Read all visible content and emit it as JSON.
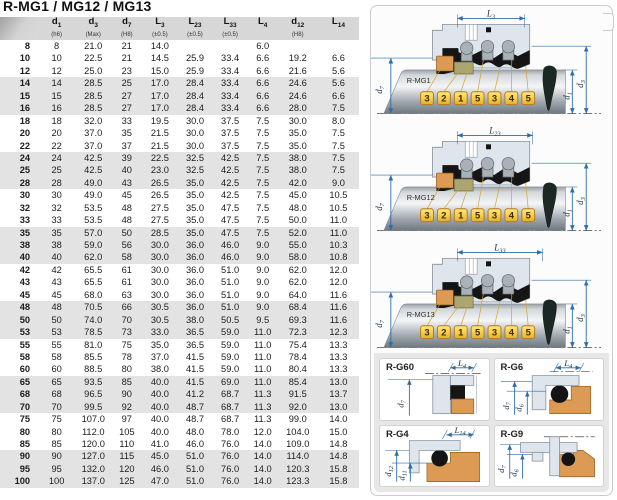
{
  "title": "R-MG1 / MG12 / MG13",
  "table": {
    "columns": [
      {
        "main": "d",
        "sub": "1",
        "note": "(h6)"
      },
      {
        "main": "d",
        "sub": "3",
        "note": "(Max)"
      },
      {
        "main": "d",
        "sub": "7",
        "note": "(H8)"
      },
      {
        "main": "L",
        "sub": "3",
        "note": "(±0.5)"
      },
      {
        "main": "L",
        "sub": "23",
        "note": "(±0.5)"
      },
      {
        "main": "L",
        "sub": "33",
        "note": "(±0.5)"
      },
      {
        "main": "L",
        "sub": "4",
        "note": ""
      },
      {
        "main": "d",
        "sub": "12",
        "note": "(H8)"
      },
      {
        "main": "L",
        "sub": "14",
        "note": ""
      }
    ],
    "rows": [
      [
        "8",
        "8",
        "21.0",
        "21",
        "14.0",
        "",
        "",
        "6.0",
        "",
        ""
      ],
      [
        "10",
        "10",
        "22.5",
        "21",
        "14.5",
        "25.9",
        "33.4",
        "6.6",
        "19.2",
        "6.6"
      ],
      [
        "12",
        "12",
        "25.0",
        "23",
        "15.0",
        "25.9",
        "33.4",
        "6.6",
        "21.6",
        "5.6"
      ],
      [
        "14",
        "14",
        "28.5",
        "25",
        "17.0",
        "28.4",
        "33.4",
        "6.6",
        "24.6",
        "5.6"
      ],
      [
        "15",
        "15",
        "28.5",
        "27",
        "17.0",
        "28.4",
        "33.4",
        "6.6",
        "24.6",
        "6.6"
      ],
      [
        "16",
        "16",
        "28.5",
        "27",
        "17.0",
        "28.4",
        "33.4",
        "6.6",
        "28.0",
        "7.5"
      ],
      [
        "18",
        "18",
        "32.0",
        "33",
        "19.5",
        "30.0",
        "37.5",
        "7.5",
        "30.0",
        "8.0"
      ],
      [
        "20",
        "20",
        "37.0",
        "35",
        "21.5",
        "30.0",
        "37.5",
        "7.5",
        "35.0",
        "7.5"
      ],
      [
        "22",
        "22",
        "37.0",
        "37",
        "21.5",
        "30.0",
        "37.5",
        "7.5",
        "35.0",
        "7.5"
      ],
      [
        "24",
        "24",
        "42.5",
        "39",
        "22.5",
        "32.5",
        "42.5",
        "7.5",
        "38.0",
        "7.5"
      ],
      [
        "25",
        "25",
        "42.5",
        "40",
        "23.0",
        "32.5",
        "42.5",
        "7.5",
        "38.0",
        "7.5"
      ],
      [
        "28",
        "28",
        "49.0",
        "43",
        "26.5",
        "35.0",
        "42.5",
        "7.5",
        "42.0",
        "9.0"
      ],
      [
        "30",
        "30",
        "49.0",
        "45",
        "26.5",
        "35.0",
        "42.5",
        "7.5",
        "45.0",
        "10.5"
      ],
      [
        "32",
        "32",
        "53.5",
        "48",
        "27.5",
        "35.0",
        "47.5",
        "7.5",
        "48.0",
        "10.5"
      ],
      [
        "33",
        "33",
        "53.5",
        "48",
        "27.5",
        "35.0",
        "47.5",
        "7.5",
        "50.0",
        "11.0"
      ],
      [
        "35",
        "35",
        "57.0",
        "50",
        "28.5",
        "35.0",
        "47.5",
        "7.5",
        "52.0",
        "11.0"
      ],
      [
        "38",
        "38",
        "59.0",
        "56",
        "30.0",
        "36.0",
        "46.0",
        "9.0",
        "55.0",
        "10.3"
      ],
      [
        "40",
        "40",
        "62.0",
        "58",
        "30.0",
        "36.0",
        "46.0",
        "9.0",
        "58.0",
        "10.8"
      ],
      [
        "42",
        "42",
        "65.5",
        "61",
        "30.0",
        "36.0",
        "51.0",
        "9.0",
        "62.0",
        "12.0"
      ],
      [
        "43",
        "43",
        "65.5",
        "61",
        "30.0",
        "36.0",
        "51.0",
        "9.0",
        "62.0",
        "12.0"
      ],
      [
        "45",
        "45",
        "68.0",
        "63",
        "30.0",
        "36.0",
        "51.0",
        "9.0",
        "64.0",
        "11.6"
      ],
      [
        "48",
        "48",
        "70.5",
        "66",
        "30.5",
        "36.0",
        "51.0",
        "9.0",
        "68.4",
        "11.6"
      ],
      [
        "50",
        "50",
        "74.0",
        "70",
        "30.5",
        "38.0",
        "50.5",
        "9.5",
        "69.3",
        "11.6"
      ],
      [
        "53",
        "53",
        "78.5",
        "73",
        "33.0",
        "36.5",
        "59.0",
        "11.0",
        "72.3",
        "12.3"
      ],
      [
        "55",
        "55",
        "81.0",
        "75",
        "35.0",
        "36.5",
        "59.0",
        "11.0",
        "75.4",
        "13.3"
      ],
      [
        "58",
        "58",
        "85.5",
        "78",
        "37.0",
        "41.5",
        "59.0",
        "11.0",
        "78.4",
        "13.3"
      ],
      [
        "60",
        "60",
        "88.5",
        "80",
        "38.0",
        "41.5",
        "59.0",
        "11.0",
        "80.4",
        "13.3"
      ],
      [
        "65",
        "65",
        "93.5",
        "85",
        "40.0",
        "41.5",
        "69.0",
        "11.0",
        "85.4",
        "13.0"
      ],
      [
        "68",
        "68",
        "96.5",
        "90",
        "40.0",
        "41.2",
        "68.7",
        "11.3",
        "91.5",
        "13.7"
      ],
      [
        "70",
        "70",
        "99.5",
        "92",
        "40.0",
        "48.7",
        "68.7",
        "11.3",
        "92.0",
        "13.0"
      ],
      [
        "75",
        "75",
        "107.0",
        "97",
        "40.0",
        "48.7",
        "68.7",
        "11.3",
        "99.0",
        "14.0"
      ],
      [
        "80",
        "80",
        "112.0",
        "105",
        "40.0",
        "48.0",
        "78.0",
        "12.0",
        "104.0",
        "15.0"
      ],
      [
        "85",
        "85",
        "120.0",
        "110",
        "41.0",
        "46.0",
        "76.0",
        "14.0",
        "109.0",
        "14.8"
      ],
      [
        "90",
        "90",
        "127.0",
        "115",
        "45.0",
        "51.0",
        "76.0",
        "14.0",
        "114.0",
        "14.8"
      ],
      [
        "95",
        "95",
        "132.0",
        "120",
        "46.0",
        "51.0",
        "76.0",
        "14.0",
        "120.3",
        "15.8"
      ],
      [
        "100",
        "100",
        "137.0",
        "125",
        "47.0",
        "51.0",
        "76.0",
        "14.0",
        "123.3",
        "15.8"
      ]
    ]
  },
  "diagrams": [
    {
      "name": "R-MG1",
      "dim": {
        "main": "L",
        "sub": "3"
      },
      "left_dim": {
        "main": "d",
        "sub": "7"
      },
      "right_dims": [
        {
          "main": "d",
          "sub": "1"
        },
        {
          "main": "d",
          "sub": "3"
        }
      ],
      "tags": [
        "3",
        "2",
        "1",
        "5",
        "3",
        "4",
        "5"
      ]
    },
    {
      "name": "R-MG12",
      "dim": {
        "main": "L",
        "sub": "23"
      },
      "left_dim": {
        "main": "d",
        "sub": "7"
      },
      "right_dims": [
        {
          "main": "d",
          "sub": "1"
        },
        {
          "main": "d",
          "sub": "3"
        }
      ],
      "tags": [
        "3",
        "2",
        "1",
        "5",
        "3",
        "4",
        "5"
      ]
    },
    {
      "name": "R-MG13",
      "dim": {
        "main": "L",
        "sub": "33"
      },
      "left_dim": {
        "main": "d",
        "sub": "7"
      },
      "right_dims": [
        {
          "main": "d",
          "sub": "1"
        },
        {
          "main": "d",
          "sub": "3"
        }
      ],
      "tags": [
        "3",
        "2",
        "1",
        "5",
        "3",
        "4",
        "5"
      ]
    }
  ],
  "panels": [
    {
      "name": "R-G60",
      "dim": {
        "main": "L",
        "sub": "4"
      },
      "left_dims": [
        {
          "main": "d",
          "sub": "7"
        }
      ]
    },
    {
      "name": "R-G6",
      "dim": {
        "main": "L",
        "sub": "4"
      },
      "left_dims": [
        {
          "main": "d",
          "sub": "7"
        },
        {
          "main": "d",
          "sub": "6"
        }
      ]
    },
    {
      "name": "R-G4",
      "dim": {
        "main": "L",
        "sub": "14"
      },
      "left_dims": [
        {
          "main": "d",
          "sub": "12"
        },
        {
          "main": "d",
          "sub": "11"
        }
      ]
    },
    {
      "name": "R-G9",
      "left_dims": [
        {
          "main": "d",
          "sub": "7"
        },
        {
          "main": "d",
          "sub": "6"
        }
      ]
    }
  ],
  "colors": {
    "dimension_blue": "#2f6da8",
    "tag_yellow": "#f2c840",
    "orange_part": "#dd9a55",
    "olive_part": "#aaa673",
    "header_gray": "#d7d7d7",
    "stripe_gray": "#e3e3e3"
  }
}
